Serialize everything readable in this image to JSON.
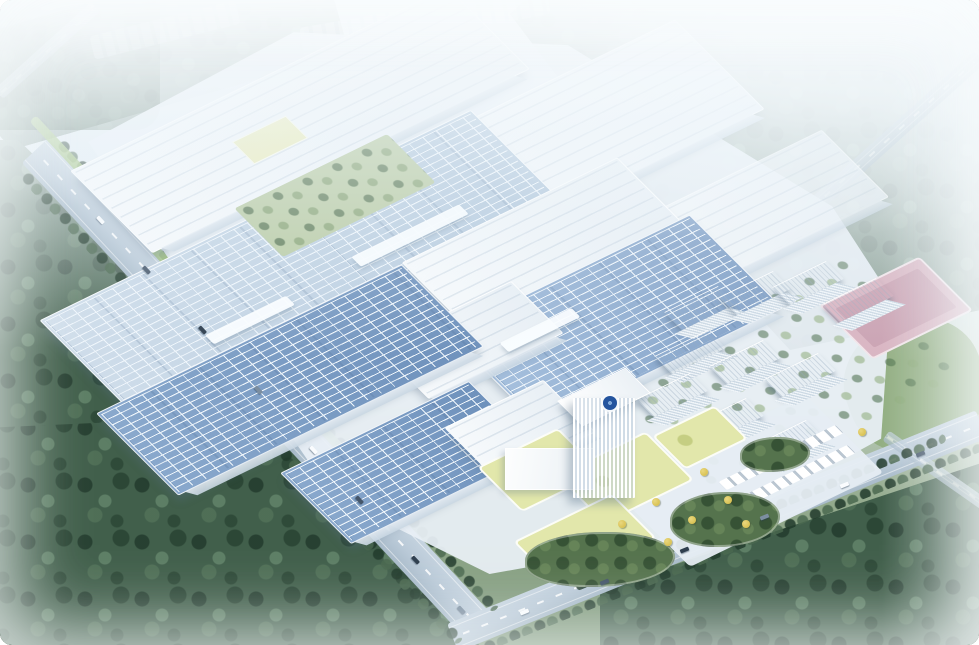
{
  "scene": {
    "kind": "aerial architectural rendering",
    "aria_label": "Bird's-eye rendering of a large smart-factory campus: rows of white factory halls with blue rooftop solar arrays, a central landscaped courtyard, a white office tower with a round blue logo, staggered dormitory towers with a pink sports court, landscaped entrance gardens with yellow-green lawns, tree-lined boulevards with traffic, all surrounded by dense forest under bright haze."
  },
  "palette": {
    "haze": "#f3f8fb",
    "ground": "#e9f0f6",
    "hall-white-a": "#f7fafc",
    "hall-white-b": "#e7eef4",
    "solar-a": "#a7c1de",
    "solar-b": "#7c9cc4",
    "solar-deep-a": "#8aa9cd",
    "solar-deep-b": "#6d90bb",
    "solar-light-a": "#cfddea",
    "solar-light-b": "#b0c6db",
    "grid-line": "#eef5fb",
    "forest": "#415f4b",
    "meadow": "#6e9466",
    "grass-right": "#93af83",
    "lawn": "#e2e7ab",
    "mound": "#55734d",
    "road": "#b9c9d7",
    "road-line": "#ffffff",
    "track": "#d9b5c2",
    "track-inner": "#cba3b3",
    "pavement": "#e6edf3",
    "tower-face": "#f8fbfd",
    "tower-shade": "#dce6ee",
    "logo-blue": "#24549e",
    "verge": "#9fc178",
    "ytree": "#d9c254"
  },
  "counts": {
    "residential_towers": 10,
    "cars_left_road": 8,
    "cars_perimeter_road": 6,
    "yellow_trees": 8
  }
}
